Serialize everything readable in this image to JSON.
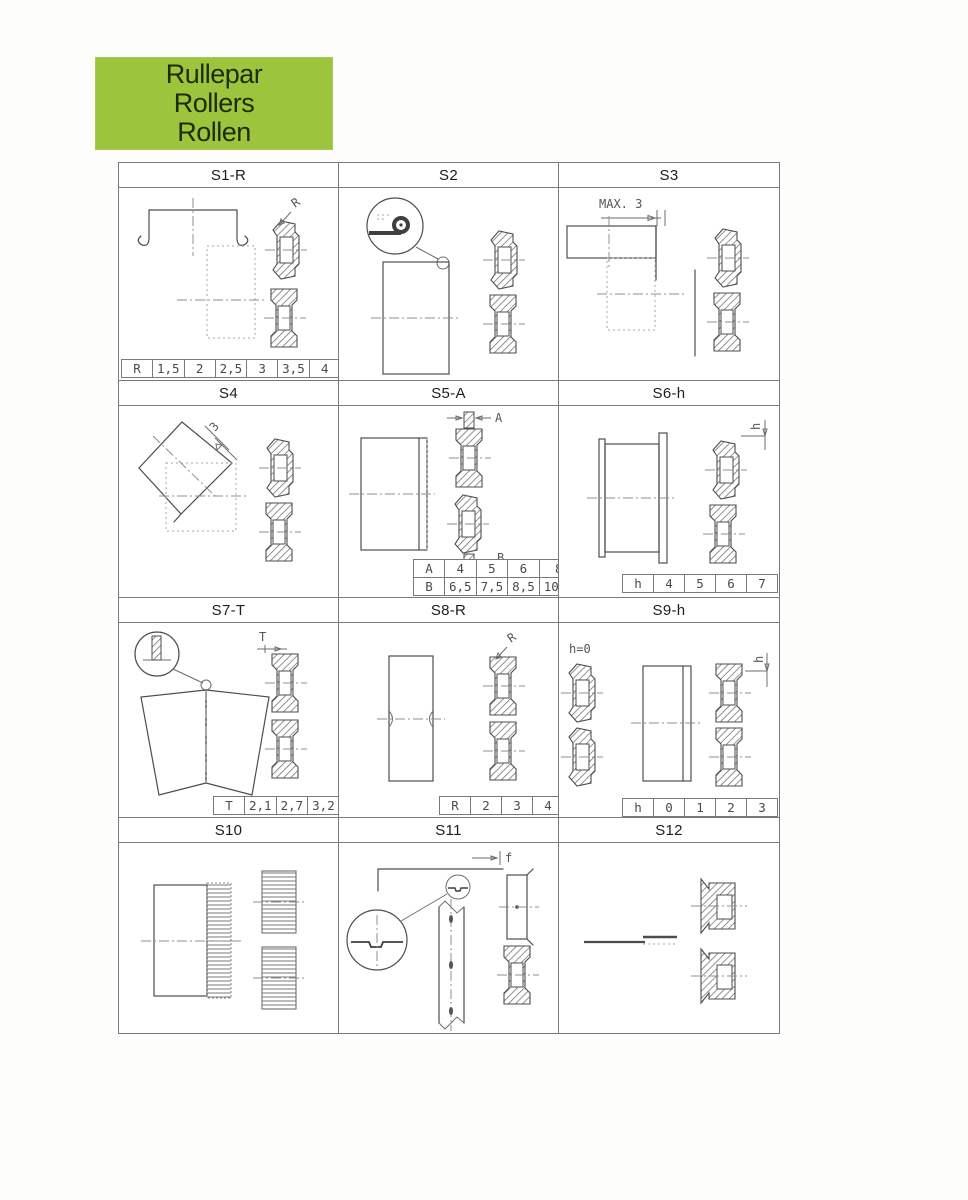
{
  "page": {
    "background": "#fdfdfc"
  },
  "header": {
    "bg_color": "#9dc43d",
    "text_color": "#1e2c09",
    "lines": [
      "Rullepar",
      "Rollers",
      "Rollen"
    ]
  },
  "grid": {
    "border_color": "#7a7a7a",
    "cells": [
      {
        "title": "S1-R",
        "dim_r": "R",
        "table": [
          [
            "R",
            "1,5",
            "2",
            "2,5",
            "3",
            "3,5",
            "4",
            "9"
          ]
        ]
      },
      {
        "title": "S2"
      },
      {
        "title": "S3",
        "dim_max": "MAX. 3"
      },
      {
        "title": "S4",
        "dim_3": "3"
      },
      {
        "title": "S5-A",
        "dim_a": "A",
        "dim_b": "B",
        "table": [
          [
            "A",
            "4",
            "5",
            "6",
            "8"
          ],
          [
            "B",
            "6,5",
            "7,5",
            "8,5",
            "10,5"
          ]
        ]
      },
      {
        "title": "S6-h",
        "dim_h": "h",
        "table": [
          [
            "h",
            "4",
            "5",
            "6",
            "7"
          ]
        ]
      },
      {
        "title": "S7-T",
        "dim_t": "T",
        "table": [
          [
            "T",
            "2,1",
            "2,7",
            "3,2"
          ]
        ]
      },
      {
        "title": "S8-R",
        "dim_r": "R",
        "table": [
          [
            "R",
            "2",
            "3",
            "4"
          ]
        ]
      },
      {
        "title": "S9-h",
        "note": "h=0",
        "dim_h": "h",
        "table": [
          [
            "h",
            "0",
            "1",
            "2",
            "3"
          ]
        ]
      },
      {
        "title": "S10"
      },
      {
        "title": "S11",
        "dim_f": "f"
      },
      {
        "title": "S12"
      }
    ]
  }
}
